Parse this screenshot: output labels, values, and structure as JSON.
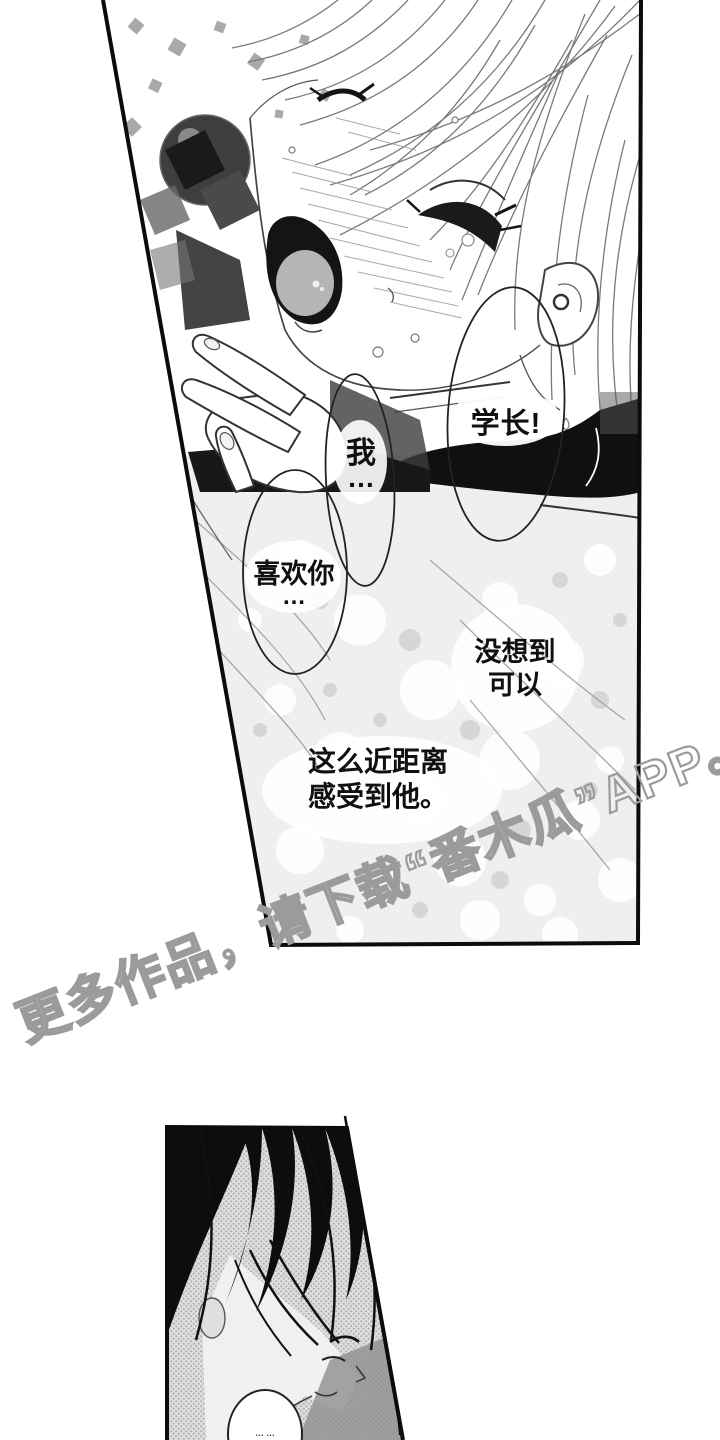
{
  "page": {
    "width": 720,
    "height": 1440,
    "background": "#ffffff",
    "kind": "manga page with two panels"
  },
  "speech": {
    "senpai": {
      "text": "学长!"
    },
    "i": {
      "line1": "我",
      "line2": "…"
    },
    "like_you": {
      "line1": "喜欢你",
      "line2": "…"
    },
    "unexpected": {
      "line1": "没想到",
      "line2": "可以"
    },
    "so_close": {
      "line1": "这么近距离",
      "line2": "感受到他。"
    },
    "bottom_murmur": {
      "text": "……"
    }
  },
  "watermark": {
    "text": "更多作品，请下载“番木瓜”APP。",
    "color": "#9b9b9b"
  },
  "colors": {
    "ink": "#111111",
    "panel_border": "#0c0c0c",
    "halftone_dot": "#adadad",
    "sparkle_base": "#ececec",
    "ribbon_black": "#101010"
  }
}
